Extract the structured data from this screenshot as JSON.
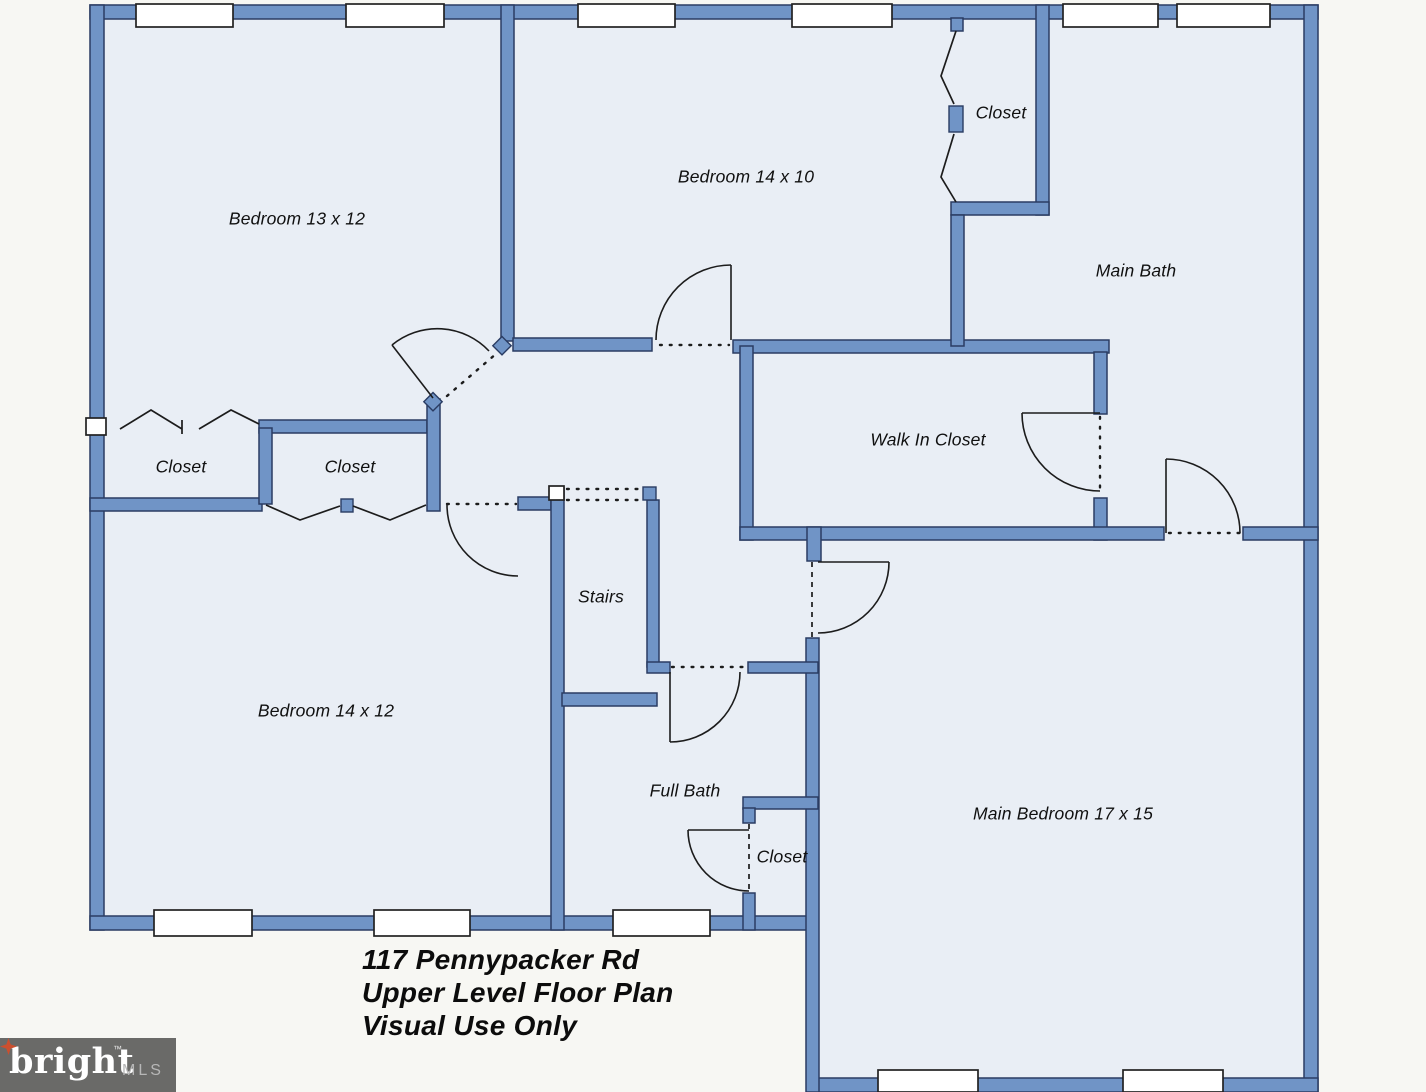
{
  "plan": {
    "rooms": {
      "bedroom_13x12": "Bedroom 13 x 12",
      "bedroom_14x10": "Bedroom 14 x 10",
      "bedroom_14x12": "Bedroom 14 x 12",
      "main_bedroom": "Main Bedroom 17 x 15",
      "main_bath": "Main Bath",
      "full_bath": "Full Bath",
      "walk_in_closet": "Walk In Closet",
      "stairs": "Stairs",
      "closet_top_right": "Closet",
      "closet_left_1": "Closet",
      "closet_left_2": "Closet",
      "closet_bottom": "Closet"
    },
    "title": {
      "line1": "117 Pennypacker Rd",
      "line2": "Upper Level Floor Plan",
      "line3": "Visual Use Only"
    },
    "logo": {
      "brand": "bright",
      "suffix": "MLS",
      "trademark": "TM"
    },
    "colors": {
      "wall": "#7094c6",
      "wall_outline": "#2a3c63",
      "interior": "#e9eef5",
      "exterior": "#f7f7f3",
      "line": "#1c1c1c",
      "logo_bg": "#6a6a68",
      "logo_star": "#cc4f2e"
    }
  }
}
